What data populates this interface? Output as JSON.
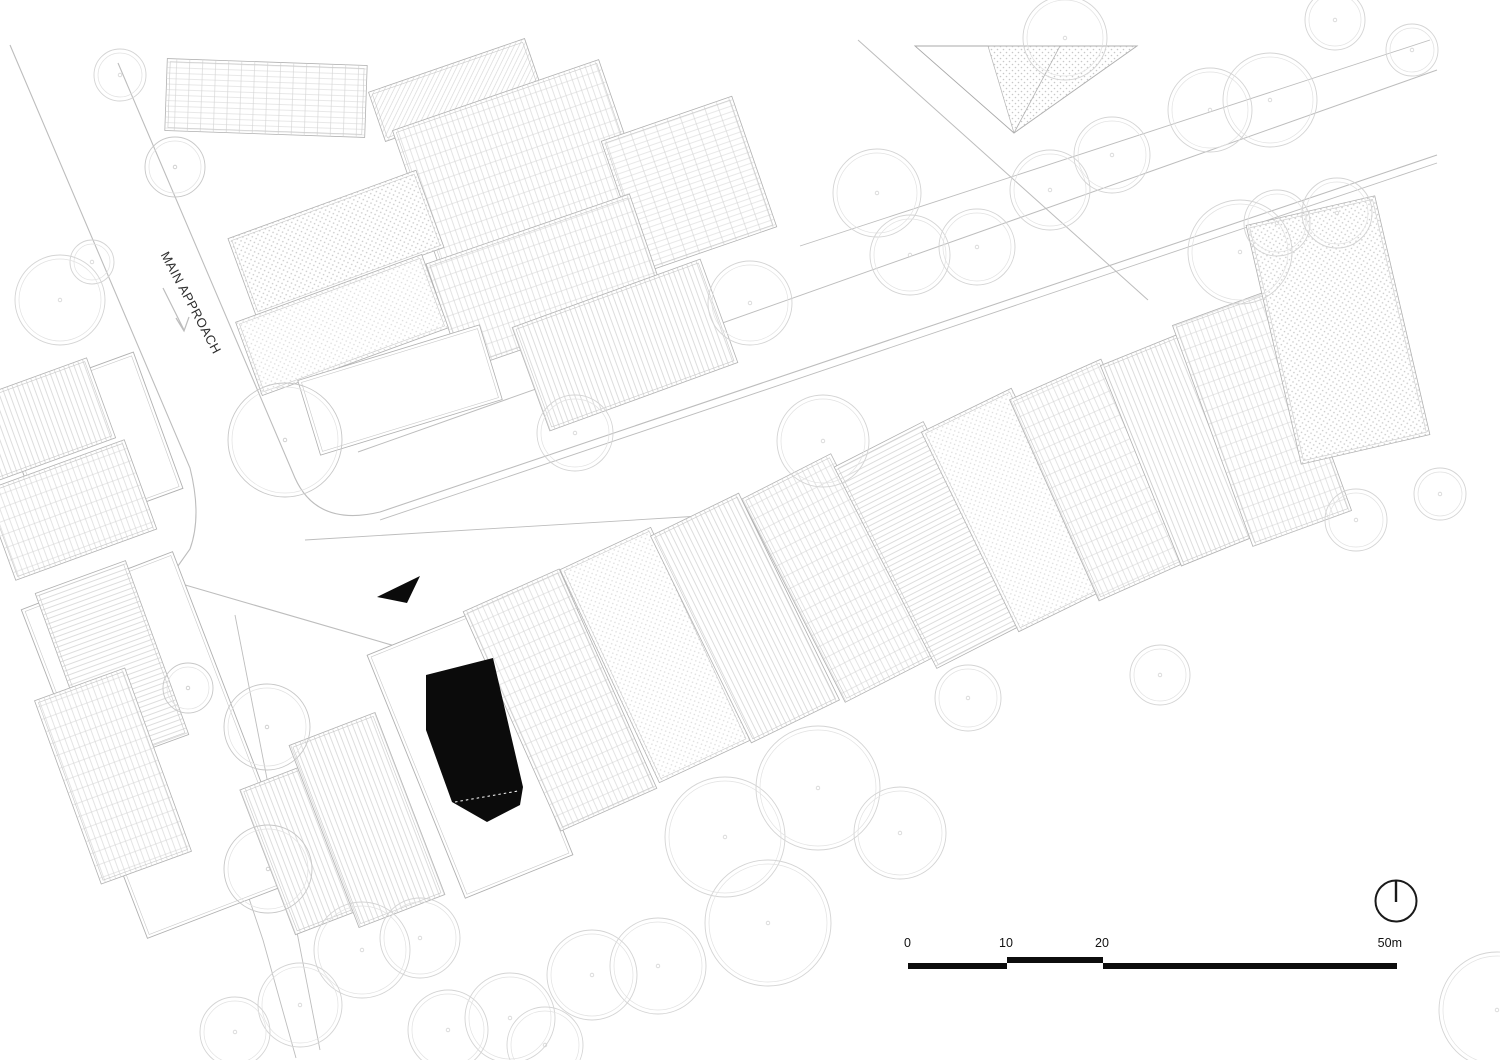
{
  "labels": {
    "main_approach": "MAIN APPROACH"
  },
  "scale_bar": {
    "ticks": [
      "0",
      "10",
      "20",
      "50m"
    ],
    "bar_color": "#0d0d0d"
  },
  "icons": {
    "north": "north-indicator-circle-with-meridian",
    "entry": "black-entry-direction-triangle",
    "approach": "gray-approach-direction-arrow"
  },
  "colors": {
    "paper": "#ffffff",
    "hatch": "#cfcfcf",
    "hatch_light": "#dadada",
    "outline": "#b0b0b0",
    "outline_inner": "#c9c9c9",
    "road": "#bdbdbd",
    "tree": "#d4d4d4",
    "tree_dark": "#c7c7c7",
    "ink": "#0b0b0b"
  },
  "drawing": {
    "canvas": {
      "w": 1500,
      "h": 1060
    },
    "roads": [
      {
        "d": "M118,63 L295,478 Q317,527 380,512 L1437,155",
        "w": 1.1
      },
      {
        "d": "M380,520 L1437,163",
        "w": 0.9
      },
      {
        "d": "M10,45 L190,468 Q202,516 190,549 L168,580 L402,648 L724,577",
        "w": 1.1
      },
      {
        "d": "M358,452 L1437,70",
        "w": 1.0
      },
      {
        "d": "M305,540 L700,516",
        "w": 0.9
      },
      {
        "d": "M858,40 L1148,300",
        "w": 1.0
      },
      {
        "d": "M800,246 L1430,40",
        "w": 0.9
      },
      {
        "d": "M143,583 L263,940 L296,1058",
        "w": 0.9
      },
      {
        "d": "M235,615 L320,1050",
        "w": 0.9
      },
      {
        "d": "M163,288 L184,330 M176,318 L184,331 L189,317",
        "w": 1.2
      }
    ],
    "plots": [
      [
        90,
        445,
        145,
        145,
        -20
      ],
      [
        160,
        745,
        162,
        352,
        -21
      ],
      [
        470,
        755,
        116,
        262,
        -22
      ]
    ],
    "roofs": [
      [
        266,
        98,
        200,
        72,
        2,
        "gridh"
      ],
      [
        455,
        90,
        165,
        52,
        -19,
        "diag"
      ],
      [
        520,
        166,
        218,
        150,
        -19,
        "grid"
      ],
      [
        689,
        184,
        138,
        138,
        -19,
        "gridh"
      ],
      [
        546,
        282,
        215,
        112,
        -19,
        "grid"
      ],
      [
        625,
        345,
        200,
        110,
        -20,
        "stripes"
      ],
      [
        336,
        243,
        200,
        82,
        -20,
        "stipple"
      ],
      [
        342,
        325,
        198,
        78,
        -20,
        "stippleLight"
      ],
      [
        400,
        390,
        190,
        78,
        -17,
        "plain"
      ],
      [
        40,
        420,
        130,
        85,
        -20,
        "stripes"
      ],
      [
        70,
        510,
        150,
        95,
        -20,
        "grid"
      ],
      [
        112,
        664,
        96,
        185,
        -20,
        "stripesh"
      ],
      [
        113,
        776,
        96,
        195,
        -20,
        "grid"
      ],
      [
        305,
        848,
        80,
        155,
        -21,
        "stripes"
      ],
      [
        367,
        820,
        92,
        195,
        -21,
        "stripes"
      ],
      [
        560,
        700,
        105,
        240,
        -24,
        "grid"
      ],
      [
        655,
        655,
        100,
        235,
        -25,
        "stippleLight"
      ],
      [
        745,
        618,
        98,
        230,
        -26,
        "stripes"
      ],
      [
        838,
        578,
        100,
        228,
        -27,
        "grid"
      ],
      [
        930,
        545,
        100,
        226,
        -27,
        "stripesh"
      ],
      [
        1015,
        510,
        100,
        222,
        -26,
        "stippleLight"
      ],
      [
        1100,
        480,
        100,
        220,
        -24,
        "grid"
      ],
      [
        1185,
        448,
        95,
        216,
        -22,
        "stripes"
      ],
      [
        1262,
        418,
        105,
        235,
        -20,
        "grid"
      ],
      [
        1338,
        330,
        132,
        245,
        -13,
        "stipple"
      ]
    ],
    "pitched": {
      "outline": "915,46 1137,46 1014,133",
      "hatch": "988,46 1137,46 1014,133",
      "ridge": "M1014,133 L1060,46"
    },
    "trees": [
      [
        120,
        75,
        26,
        0
      ],
      [
        175,
        167,
        30,
        1
      ],
      [
        92,
        262,
        22,
        0
      ],
      [
        60,
        300,
        45,
        0
      ],
      [
        285,
        440,
        57,
        1
      ],
      [
        575,
        433,
        38,
        0
      ],
      [
        750,
        303,
        42,
        0
      ],
      [
        823,
        441,
        46,
        0
      ],
      [
        877,
        193,
        44,
        0
      ],
      [
        910,
        255,
        40,
        0
      ],
      [
        977,
        247,
        38,
        0
      ],
      [
        1050,
        190,
        40,
        0
      ],
      [
        1112,
        155,
        38,
        0
      ],
      [
        1210,
        110,
        42,
        0
      ],
      [
        1270,
        100,
        47,
        0
      ],
      [
        1065,
        38,
        42,
        0
      ],
      [
        1335,
        20,
        30,
        0
      ],
      [
        1277,
        223,
        33,
        0
      ],
      [
        1240,
        252,
        52,
        0
      ],
      [
        1337,
        213,
        35,
        0
      ],
      [
        1412,
        50,
        26,
        0
      ],
      [
        1356,
        520,
        31,
        0
      ],
      [
        1440,
        494,
        26,
        0
      ],
      [
        968,
        698,
        33,
        0
      ],
      [
        1160,
        675,
        30,
        0
      ],
      [
        725,
        837,
        60,
        0
      ],
      [
        818,
        788,
        62,
        0
      ],
      [
        900,
        833,
        46,
        0
      ],
      [
        768,
        923,
        63,
        0
      ],
      [
        658,
        966,
        48,
        0
      ],
      [
        592,
        975,
        45,
        0
      ],
      [
        362,
        950,
        48,
        0
      ],
      [
        300,
        1005,
        42,
        0
      ],
      [
        420,
        938,
        40,
        0
      ],
      [
        510,
        1018,
        45,
        0
      ],
      [
        448,
        1030,
        40,
        0
      ],
      [
        188,
        688,
        25,
        1
      ],
      [
        267,
        727,
        43,
        1
      ],
      [
        268,
        869,
        44,
        1
      ],
      [
        1497,
        1010,
        58,
        0
      ],
      [
        545,
        1045,
        38,
        0
      ],
      [
        235,
        1032,
        35,
        0
      ]
    ],
    "highlight_building": {
      "points": "426,675 493,658 523,787 520,805 487,822 452,802 426,730",
      "entry_dash": "M455,802 L518,791"
    },
    "entry_arrow": {
      "points": "377,597 420,576 407,603"
    },
    "north": {
      "cx": 1396,
      "cy": 901,
      "r": 20.5
    }
  }
}
